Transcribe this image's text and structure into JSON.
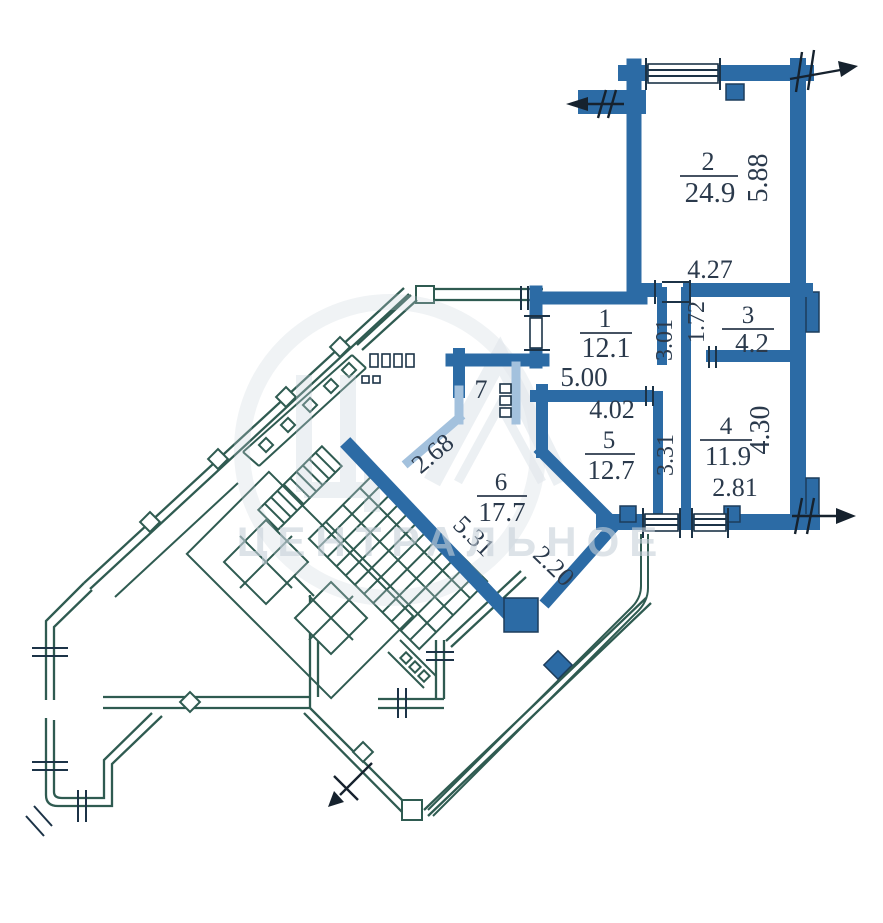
{
  "plan": {
    "type": "apartment_floor_plan",
    "rooms": [
      {
        "number": "1",
        "area": "12.1"
      },
      {
        "number": "2",
        "area": "24.9"
      },
      {
        "number": "3",
        "area": "4.2"
      },
      {
        "number": "4",
        "area": "11.9"
      },
      {
        "number": "5",
        "area": "12.7"
      },
      {
        "number": "6",
        "area": "17.7"
      },
      {
        "number": "7",
        "area": ""
      }
    ],
    "dimensions": {
      "room1_width": "5.00",
      "room2_height": "5.88",
      "room2_width": "4.27",
      "room3_height": "1.72",
      "shaft_upper": "3.01",
      "shaft_lower": "3.31",
      "room4_height": "4.30",
      "room4_width": "2.81",
      "room5_width": "4.02",
      "room6_nw": "2.68",
      "room6_sw": "5.31",
      "room6_se": "2.20"
    },
    "watermark": {
      "text": "ЦЕНТРАЛЬНОЕ"
    },
    "colors": {
      "apartment_wall": "#2c6ba5",
      "light_partition": "#a3c1dd",
      "building_outline": "#2f5b51",
      "detail_ink": "#1c3347",
      "label_text": "#2b3a4c",
      "watermark": "#c7d1da"
    }
  }
}
